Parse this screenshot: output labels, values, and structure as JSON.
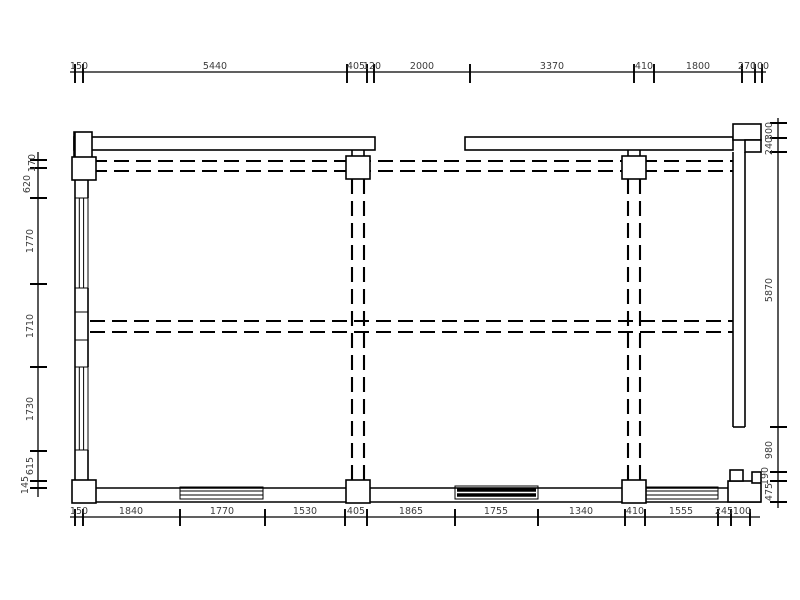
{
  "drawing": {
    "background_color": "#ffffff",
    "line_color": "#000000",
    "text_color": "#3d3d3d",
    "dims_top": [
      "150",
      "5440",
      "405",
      "120",
      "2000",
      "3370",
      "410",
      "1800",
      "270",
      "100"
    ],
    "dims_bottom": [
      "150",
      "1840",
      "1770",
      "1530",
      "405",
      "1865",
      "1755",
      "1340",
      "410",
      "1555",
      "245",
      "100"
    ],
    "dims_left": [
      "170",
      "620",
      "1770",
      "1710",
      "1730",
      "615",
      "145"
    ],
    "dims_right": [
      "300",
      "240",
      "5870",
      "980",
      "190",
      "475"
    ]
  }
}
